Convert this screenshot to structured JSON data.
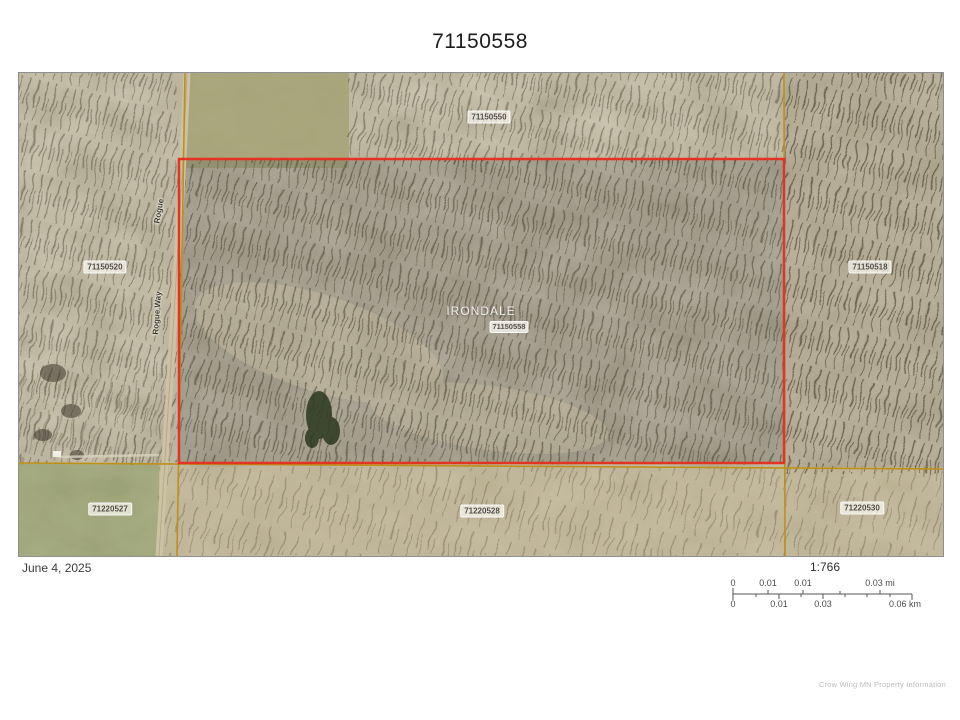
{
  "title": "71150558",
  "map": {
    "parcel_labels": [
      {
        "text": "71150550"
      },
      {
        "text": "71150520"
      },
      {
        "text": "71150518"
      },
      {
        "text": "71220527"
      },
      {
        "text": "71220528"
      },
      {
        "text": "71220530"
      }
    ],
    "selected_parcel": {
      "name": "IRONDALE",
      "id": "71150558"
    },
    "road_labels": [
      {
        "text": "Rogue"
      },
      {
        "text": "Rogue Way"
      }
    ],
    "colors": {
      "selected_boundary": "#e33322",
      "parcel_lines": "#bf9018",
      "selection_tint": "rgba(75,72,78,0.22)"
    }
  },
  "footer": {
    "date": "June 4, 2025",
    "scale_ratio": "1:766",
    "scale_mi_labels": [
      "0",
      "0.01",
      "0.01",
      "0.03 mi"
    ],
    "scale_km_labels": [
      "0",
      "0.01",
      "0.03",
      "0.06 km"
    ],
    "attribution": "Crow Wing MN Property Information"
  }
}
